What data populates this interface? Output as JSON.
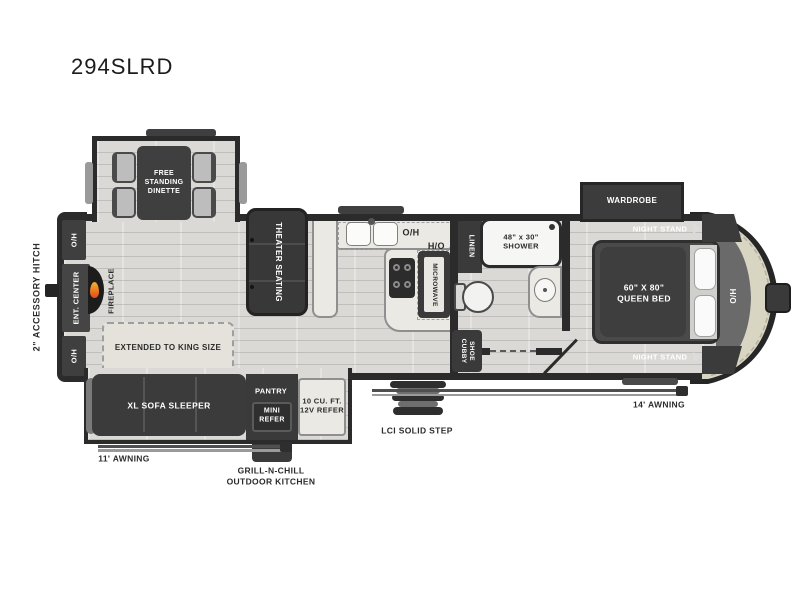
{
  "palette": {
    "wall": "#2b2b2b",
    "furniture_dark": "#3a3a3a",
    "floor": "#dad9d6",
    "counter": "#ebe9e3",
    "cap_cream": "#d9d5c3",
    "cap_gray": "#6a6a6a",
    "flame_orange": "#e8682a",
    "label_light": "#ffffff",
    "label_dark": "#2b2b2b"
  },
  "title": "294SLRD",
  "exterior": {
    "accessory_hitch_label": "2\" ACCESSORY HITCH",
    "awning_11_label": "11' AWNING",
    "awning_14_label": "14' AWNING",
    "step_label": "LCI SOLID STEP",
    "outdoor_kitchen_label": "GRILL-N-CHILL\nOUTDOOR  KITCHEN",
    "front_overhead_label": "O/H"
  },
  "living_area": {
    "overhead_rear_top_label": "O/H",
    "ent_center_label": "ENT. CENTER",
    "overhead_rear_bottom_label": "O/H",
    "fireplace_label": "FIREPLACE",
    "dinette_label": "FREE\nSTANDING\nDINETTE",
    "theater_label": "THEATER SEATING",
    "sofa_label": "XL SOFA SLEEPER",
    "king_extension_label": "EXTENDED TO KING SIZE",
    "pantry_label": "PANTRY",
    "mini_refer_label": "MINI\nREFER",
    "refer_label": "10 CU. FT.\n12V REFER"
  },
  "kitchen": {
    "overhead_label_1": "O/H",
    "overhead_label_2": "O/H",
    "microwave_label": "MICROWAVE"
  },
  "bathroom": {
    "linen_label": "LINEN",
    "shower_label": "48\" x 30\"\nSHOWER",
    "shoe_cubby_label": "SHOE\nCUBBY"
  },
  "bedroom": {
    "wardrobe_label": "WARDROBE",
    "night_stand_top_label": "NIGHT STAND",
    "night_stand_bottom_label": "NIGHT STAND",
    "bed_label": "60\" X 80\"\nQUEEN BED"
  }
}
